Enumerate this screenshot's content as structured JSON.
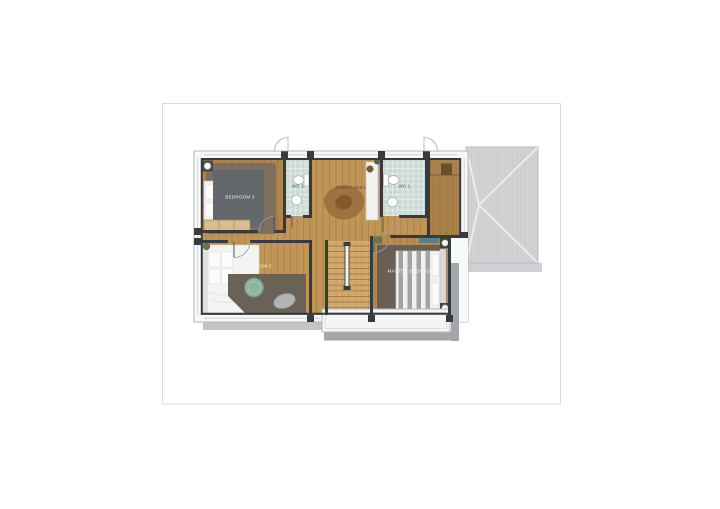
{
  "card": {
    "background": "#ffffff",
    "border_color": "#dadada"
  },
  "floor_plan": {
    "rooms": [
      {
        "name": "bedroom-3",
        "label": "BEDROOM 3"
      },
      {
        "name": "wc-2",
        "label": "WC 2"
      },
      {
        "name": "family-area",
        "label": "FAMILY AREA"
      },
      {
        "name": "wc-1",
        "label": "WC 1"
      },
      {
        "name": "walk-in-closet",
        "label_lines": [
          "WALK IN",
          "CLOSET"
        ]
      },
      {
        "name": "bedroom-2",
        "label": "BEDROOM 2"
      },
      {
        "name": "master-bedroom",
        "label": "MASTER BEDROOM"
      }
    ],
    "colors": {
      "wood": "#c19457",
      "tile": "#cbd9d5",
      "wall_dark": "#383b3e",
      "wall_light": "#f7f8f8",
      "roof": "#d3d4d6",
      "accent_green": "#8cb2a0"
    }
  }
}
